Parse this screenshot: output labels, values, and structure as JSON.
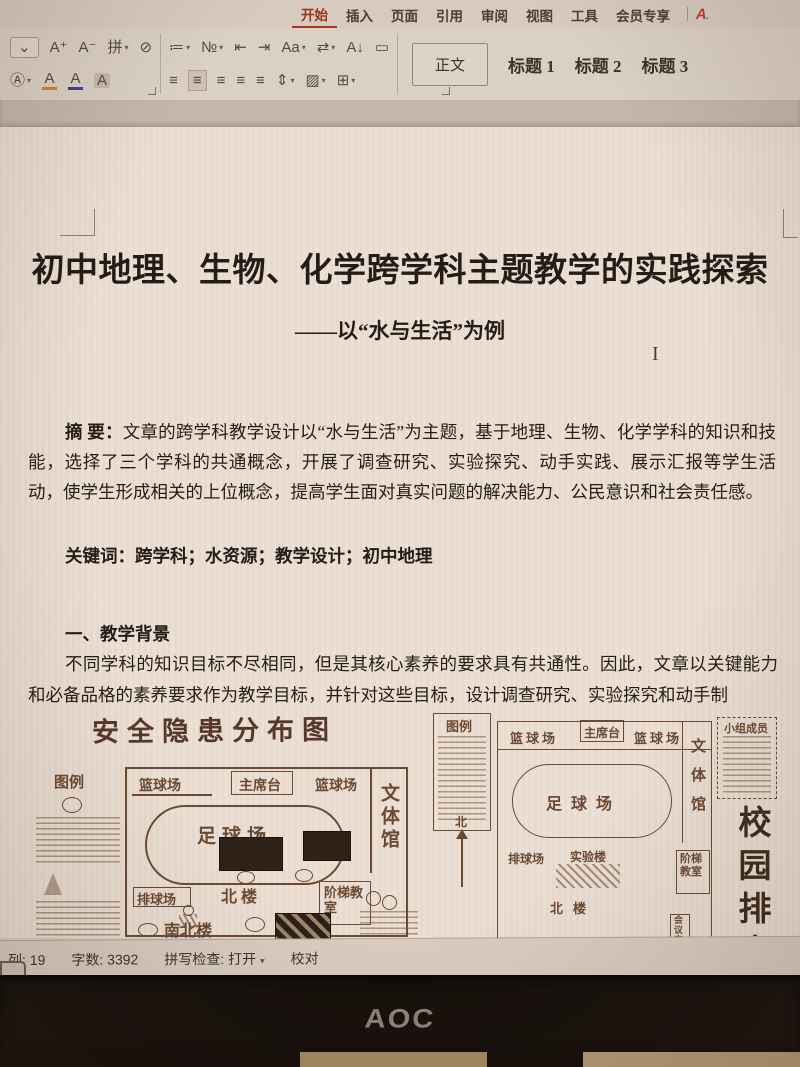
{
  "ribbon": {
    "tabs": [
      {
        "label": "开始"
      },
      {
        "label": "插入"
      },
      {
        "label": "页面"
      },
      {
        "label": "引用"
      },
      {
        "label": "审阅"
      },
      {
        "label": "视图"
      },
      {
        "label": "工具"
      },
      {
        "label": "会员专享"
      }
    ]
  },
  "toolbar": {
    "collapse": "⌄",
    "inc_font": "A⁺",
    "dec_font": "A⁻",
    "phonetic": "拼",
    "clear_format": "⊘",
    "wordart": "Ⓐ",
    "highlight": "A",
    "font_color": "A",
    "char_shade": "A",
    "bullets": "≔",
    "numbering": "№",
    "outdent": "⇤",
    "indent": "⇥",
    "case": "Aa",
    "direction": "⇄",
    "sort": "A↓",
    "marks": "▭",
    "align_left": "≡",
    "align_center": "≡",
    "align_right": "≡",
    "justify": "≡",
    "distribute": "≡",
    "line_spacing": "⇕",
    "shading": "▨",
    "borders": "⊞",
    "chevron": "▾"
  },
  "styles_gallery": {
    "normal": "正文",
    "h1": "标题 1",
    "h2": "标题 2",
    "h3": "标题 3"
  },
  "doc": {
    "title": "初中地理、生物、化学跨学科主题教学的实践探索",
    "subtitle": "——以“水与生活”为例",
    "abstract_label": "摘 要：",
    "abstract_text": "文章的跨学科教学设计以“水与生活”为主题，基于地理、生物、化学学科的知识和技能，选择了三个学科的共通概念，开展了调查研究、实验探究、动手实践、展示汇报等学生活动，使学生形成相关的上位概念，提高学生面对真实问题的解决能力、公民意识和社会责任感。",
    "keywords": "关键词：跨学科；水资源；教学设计；初中地理",
    "heading1": "一、教学背景",
    "para1": "不同学科的知识目标不尽相同，但是其核心素养的要求具有共通性。因此，文章以关键能力和必备品格的素养要求作为教学目标，并针对这些目标，设计调查研究、实验探究和动手制"
  },
  "fig_left": {
    "title": "安全隐患分布图",
    "legend": "图例",
    "bball1": "篮球场",
    "stage": "主席台",
    "bball2": "篮球场",
    "gym": "文体馆",
    "soccer": "足球场",
    "volley": "排球场",
    "north_bldg": "北楼",
    "stairs_room": "阶梯教室",
    "south_north_bldg": "南北楼"
  },
  "fig_right": {
    "legend": "图例",
    "bball1": "篮球场",
    "stage": "主席台",
    "bball2": "篮球场",
    "gym": "文体馆",
    "soccer": "足球场",
    "volley": "排球场",
    "lab": "实验楼",
    "stairs_room": "阶梯教室",
    "north_bldg": "北楼",
    "meeting": "会议室",
    "members": "小组成员",
    "north": "北",
    "side_text": "校园排水口"
  },
  "status_bar": {
    "column": "列: 19",
    "words": "字数: 3392",
    "spell": "拼写检查: 打开",
    "proof": "校对"
  },
  "monitor": {
    "brand": "AOC"
  },
  "colors": {
    "accent_red": "#b03425",
    "ink": "#6b4a33",
    "page": "#ecdfd3"
  }
}
